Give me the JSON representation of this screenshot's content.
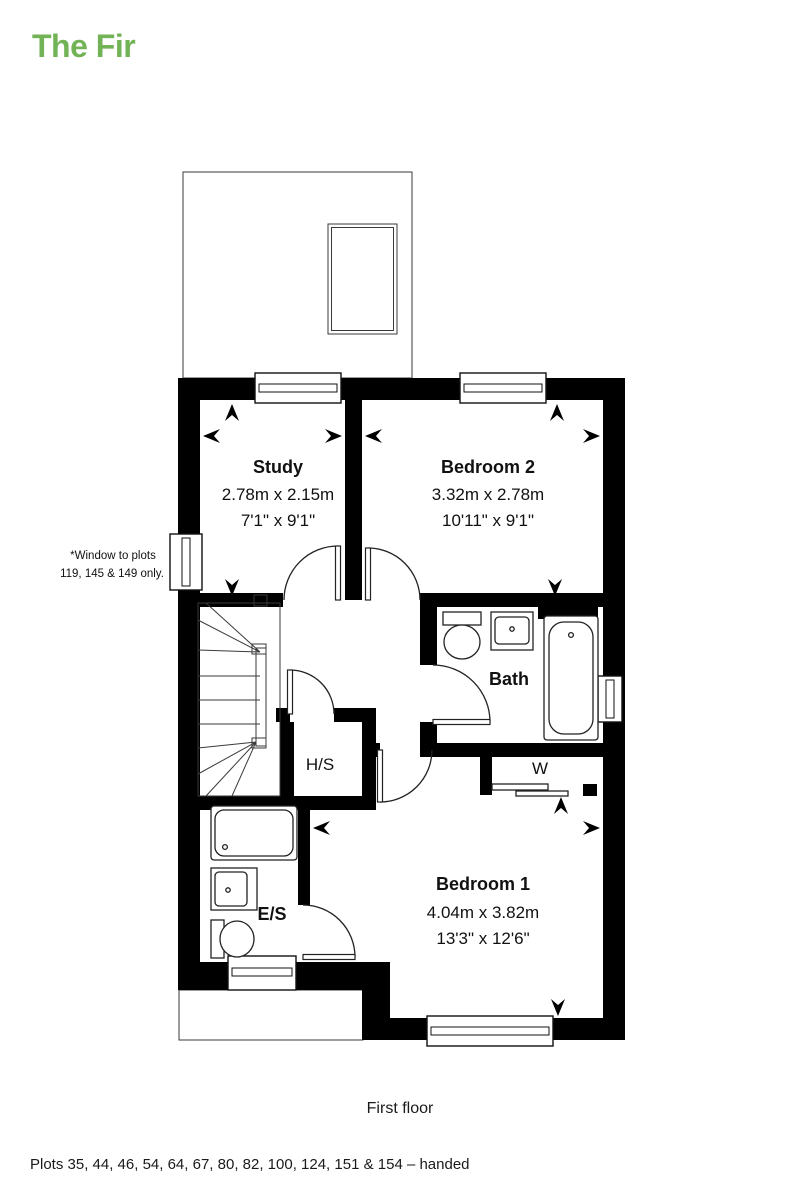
{
  "page": {
    "title": "The Fir",
    "floor_label": "First floor",
    "plots_note": "Plots 35, 44, 46, 54, 64, 67, 80, 82, 100, 124, 151 & 154 – handed"
  },
  "window_note": {
    "line1": "*Window to plots",
    "line2": "119, 145 & 149 only."
  },
  "rooms": {
    "study": {
      "name": "Study",
      "metric": "2.78m x 2.15m",
      "imperial": "7'1\" x 9'1\""
    },
    "bedroom2": {
      "name": "Bedroom 2",
      "metric": "3.32m x 2.78m",
      "imperial": "10'11\" x 9'1\""
    },
    "bedroom1": {
      "name": "Bedroom 1",
      "metric": "4.04m x 3.82m",
      "imperial": "13'3\" x 12'6\""
    },
    "bath": {
      "name": "Bath"
    },
    "ensuite": {
      "name": "E/S"
    },
    "hs": {
      "name": "H/S"
    },
    "wardrobe": {
      "name": "W"
    }
  },
  "colors": {
    "title_green": "#72b356",
    "wall": "#000000",
    "text": "#111111"
  }
}
